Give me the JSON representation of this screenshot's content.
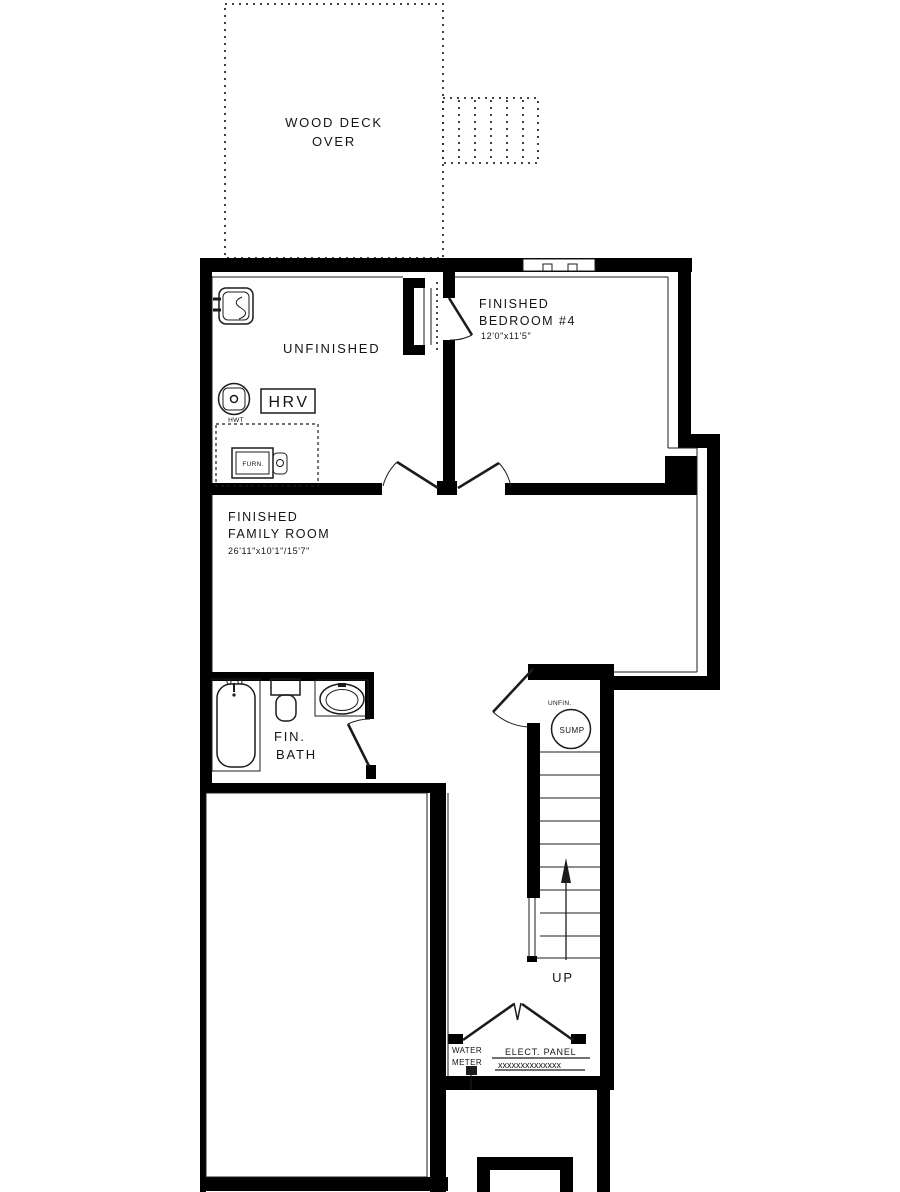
{
  "plan_title": "Basement Floor Plan",
  "colors": {
    "wall": "#000000",
    "line": "#1c1c1c",
    "background": "#ffffff"
  },
  "deck": {
    "line1": "WOOD DECK",
    "line2": "OVER"
  },
  "rooms": {
    "unfinished": {
      "label": "UNFINISHED"
    },
    "bedroom": {
      "line1": "FINISHED",
      "line2": "BEDROOM #4",
      "dims": "12'0\"x11'5\""
    },
    "family": {
      "line1": "FINISHED",
      "line2": "FAMILY ROOM",
      "dims": "26'11\"x10'1\"/15'7\""
    },
    "bath": {
      "line1": "FIN.",
      "line2": "BATH"
    },
    "sump_closet": {
      "label": "UNFIN.",
      "pit": "SUMP"
    }
  },
  "equipment": {
    "hrv": "HRV",
    "hwt": "HWT",
    "furnace": "FURN."
  },
  "stairs": {
    "direction": "UP"
  },
  "utilities": {
    "water_meter_line1": "WATER",
    "water_meter_line2": "METER",
    "elect_panel": "ELECT. PANEL",
    "panel_hatch": "xxxxxxxxxxxxxx"
  }
}
